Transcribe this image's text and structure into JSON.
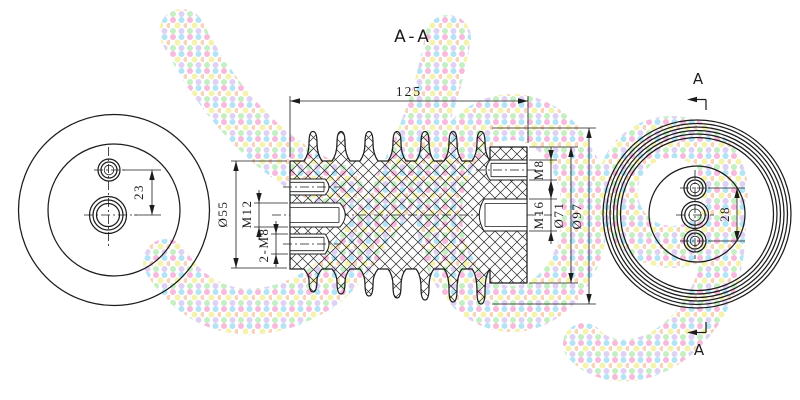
{
  "labels": {
    "section_title": "A-A",
    "section_arrow_top": "A",
    "section_arrow_bottom": "A"
  },
  "dimensions": {
    "overall_length": "125",
    "left_boss_diameter": "Ø55",
    "left_center_thread": "M12",
    "left_pair_threads": "2-M8",
    "right_top_thread": "M8",
    "right_center_thread": "M16",
    "right_flange_diameter": "Ø71",
    "shed_diameter": "Ø97",
    "left_view_hole_offset": "23",
    "right_view_hole_spacing": "28"
  },
  "style": {
    "line_color": "#1c1c1c",
    "background": "#ffffff",
    "watermark_dot_colors": [
      "#f6a9d5",
      "#9fdef5",
      "#f3ef9a",
      "#b5ecb5",
      "#d8c6f2",
      "#f8c9a8"
    ]
  }
}
